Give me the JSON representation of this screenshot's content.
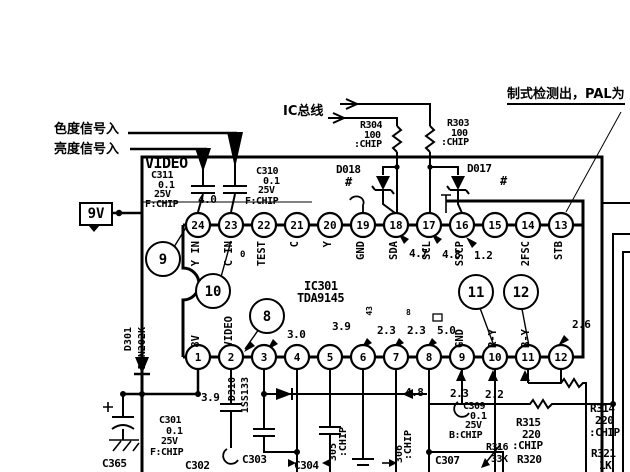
{
  "title": "TDA9145 chroma decoder schematic (scan)",
  "labels": {
    "v9": "9V"
  },
  "ic": {
    "ref": "IC301",
    "part": "TDA9145",
    "top_pins": [
      {
        "n": "24",
        "label": "Y IN"
      },
      {
        "n": "23",
        "label": "C IN"
      },
      {
        "n": "22",
        "label": "TEST"
      },
      {
        "n": "21",
        "label": "C"
      },
      {
        "n": "20",
        "label": "Y"
      },
      {
        "n": "19",
        "label": "GND"
      },
      {
        "n": "18",
        "label": "SDA"
      },
      {
        "n": "17",
        "label": "SCL"
      },
      {
        "n": "16",
        "label": "SSCP"
      },
      {
        "n": "15",
        "label": ""
      },
      {
        "n": "14",
        "label": "2FSC"
      },
      {
        "n": "13",
        "label": "STB"
      }
    ],
    "bottom_pins": [
      {
        "n": "1",
        "label": "8V"
      },
      {
        "n": "2",
        "label": "VIDEO"
      },
      {
        "n": "3",
        "label": ""
      },
      {
        "n": "4",
        "label": ""
      },
      {
        "n": "5",
        "label": ""
      },
      {
        "n": "6",
        "label": ""
      },
      {
        "n": "7",
        "label": ""
      },
      {
        "n": "8",
        "label": ""
      },
      {
        "n": "9",
        "label": "GND"
      },
      {
        "n": "10",
        "label": "R-Y"
      },
      {
        "n": "11",
        "label": "B-Y"
      },
      {
        "n": "12",
        "label": ""
      }
    ]
  },
  "callouts": [
    {
      "n": "9",
      "x": 163,
      "y": 259
    },
    {
      "n": "10",
      "x": 213,
      "y": 291
    },
    {
      "n": "8",
      "x": 267,
      "y": 316
    },
    {
      "n": "11",
      "x": 476,
      "y": 292
    },
    {
      "n": "12",
      "x": 521,
      "y": 292
    }
  ],
  "texts": [
    {
      "name": "chroma-in-label",
      "t": "色度信号入",
      "x": 54,
      "y": 123,
      "s": 13,
      "zh": 1
    },
    {
      "name": "luma-in-label",
      "t": "亮度信号入",
      "x": 54,
      "y": 143,
      "s": 13,
      "zh": 1
    },
    {
      "name": "ic-bus-label",
      "t": "IC总线",
      "x": 283,
      "y": 105,
      "s": 13,
      "zh": 1
    },
    {
      "name": "standard-detect-label",
      "t": "制式检测出，PAL为",
      "x": 507,
      "y": 88,
      "s": 13,
      "zh": 1,
      "ul": 1
    },
    {
      "name": "video-block-label",
      "t": "VIDEO",
      "x": 145,
      "y": 156,
      "s": 15
    },
    {
      "name": "c311-ref",
      "t": "C311",
      "x": 151,
      "y": 171,
      "s": 10
    },
    {
      "name": "c311-value",
      "t": "0.1",
      "x": 158,
      "y": 181,
      "s": 10
    },
    {
      "name": "c311-voltage",
      "t": "25V",
      "x": 154,
      "y": 190,
      "s": 10
    },
    {
      "name": "c311-type",
      "t": "F:CHIP",
      "x": 145,
      "y": 200,
      "s": 10
    },
    {
      "name": "c310-ref",
      "t": "C310",
      "x": 256,
      "y": 167,
      "s": 10
    },
    {
      "name": "c310-value",
      "t": "0.1",
      "x": 263,
      "y": 177,
      "s": 10
    },
    {
      "name": "c310-voltage",
      "t": "25V",
      "x": 258,
      "y": 186,
      "s": 10
    },
    {
      "name": "c310-type",
      "t": "F:CHIP",
      "x": 245,
      "y": 197,
      "s": 10
    },
    {
      "name": "pin24-voltage",
      "t": "4.0",
      "x": 198,
      "y": 194,
      "s": 11
    },
    {
      "name": "r304-ref",
      "t": "R304",
      "x": 360,
      "y": 121,
      "s": 10
    },
    {
      "name": "r304-value",
      "t": "100",
      "x": 364,
      "y": 131,
      "s": 10
    },
    {
      "name": "r304-type",
      "t": ":CHIP",
      "x": 354,
      "y": 140,
      "s": 10
    },
    {
      "name": "r303-ref",
      "t": "R303",
      "x": 447,
      "y": 119,
      "s": 10
    },
    {
      "name": "r303-value",
      "t": "100",
      "x": 451,
      "y": 129,
      "s": 10
    },
    {
      "name": "r303-type",
      "t": ":CHIP",
      "x": 441,
      "y": 138,
      "s": 10
    },
    {
      "name": "d018-ref",
      "t": "D018",
      "x": 336,
      "y": 164,
      "s": 11
    },
    {
      "name": "d018-mark",
      "t": "#",
      "x": 345,
      "y": 176,
      "s": 12
    },
    {
      "name": "d017-ref",
      "t": "D017",
      "x": 467,
      "y": 163,
      "s": 11
    },
    {
      "name": "d017-mark",
      "t": "#",
      "x": 500,
      "y": 175,
      "s": 12
    },
    {
      "name": "ic-ref",
      "t": "IC301",
      "x": 304,
      "y": 280,
      "s": 12
    },
    {
      "name": "ic-part",
      "t": "TDA9145",
      "x": 297,
      "y": 292,
      "s": 12
    },
    {
      "name": "pin23-note",
      "t": "0",
      "x": 240,
      "y": 251,
      "s": 9
    },
    {
      "name": "pin18-voltage",
      "t": "4.7",
      "x": 409,
      "y": 248,
      "s": 11
    },
    {
      "name": "pin17-voltage",
      "t": "4.8",
      "x": 442,
      "y": 249,
      "s": 11
    },
    {
      "name": "pin16-voltage",
      "t": "1.2",
      "x": 474,
      "y": 250,
      "s": 11
    },
    {
      "name": "pin3-voltage",
      "t": "3.0",
      "x": 287,
      "y": 329,
      "s": 11
    },
    {
      "name": "pin5-voltage",
      "t": "3.9",
      "x": 332,
      "y": 321,
      "s": 11
    },
    {
      "name": "pin6-note",
      "t": "43",
      "x": 366,
      "y": 306,
      "s": 8,
      "v": 1
    },
    {
      "name": "pin6-voltage",
      "t": "2.3",
      "x": 377,
      "y": 325,
      "s": 11
    },
    {
      "name": "pin7-note",
      "t": "8",
      "x": 406,
      "y": 309,
      "s": 8
    },
    {
      "name": "pin7-voltage",
      "t": "2.3",
      "x": 407,
      "y": 325,
      "s": 11
    },
    {
      "name": "pin8-voltage",
      "t": "5.0",
      "x": 437,
      "y": 325,
      "s": 11
    },
    {
      "name": "pin12-voltage",
      "t": "2.6",
      "x": 572,
      "y": 319,
      "s": 11
    },
    {
      "name": "pin2-voltage",
      "t": "3.9",
      "x": 201,
      "y": 392,
      "s": 11
    },
    {
      "name": "pin8-lower-voltage",
      "t": "4.8",
      "x": 405,
      "y": 387,
      "s": 11
    },
    {
      "name": "pin10-voltage",
      "t": "2.3",
      "x": 450,
      "y": 388,
      "s": 11
    },
    {
      "name": "pin11-voltage",
      "t": "2.2",
      "x": 485,
      "y": 389,
      "s": 11
    },
    {
      "name": "d301-ref",
      "t": "D301",
      "x": 124,
      "y": 327,
      "s": 10,
      "v": 1
    },
    {
      "name": "d301-part",
      "t": "DAN202K",
      "x": 138,
      "y": 327,
      "s": 10,
      "v": 1
    },
    {
      "name": "d310-ref",
      "t": "D310",
      "x": 228,
      "y": 377,
      "s": 10,
      "v": 1
    },
    {
      "name": "d310-part",
      "t": "1SS133",
      "x": 241,
      "y": 377,
      "s": 10,
      "v": 1
    },
    {
      "name": "c301-ref",
      "t": "C301",
      "x": 159,
      "y": 416,
      "s": 10
    },
    {
      "name": "c301-value",
      "t": "0.1",
      "x": 166,
      "y": 427,
      "s": 10
    },
    {
      "name": "c301-voltage",
      "t": "25V",
      "x": 161,
      "y": 437,
      "s": 10
    },
    {
      "name": "c301-type",
      "t": "F:CHIP",
      "x": 150,
      "y": 448,
      "s": 10
    },
    {
      "name": "c365-ref",
      "t": "C365",
      "x": 102,
      "y": 458,
      "s": 11
    },
    {
      "name": "c302-ref",
      "t": "C302",
      "x": 185,
      "y": 460,
      "s": 11
    },
    {
      "name": "c303-ref",
      "t": "C303",
      "x": 242,
      "y": 454,
      "s": 11
    },
    {
      "name": "c304-ref",
      "t": "C304",
      "x": 294,
      "y": 460,
      "s": 11
    },
    {
      "name": "c305-ref",
      "t": "305",
      "x": 329,
      "y": 443,
      "s": 10,
      "v": 1
    },
    {
      "name": "c305-type",
      "t": ":CHIP",
      "x": 339,
      "y": 427,
      "s": 10,
      "v": 1
    },
    {
      "name": "c306-ref",
      "t": "306",
      "x": 395,
      "y": 445,
      "s": 10,
      "v": 1
    },
    {
      "name": "c306-type",
      "t": ":CHIP",
      "x": 404,
      "y": 430,
      "s": 10,
      "v": 1
    },
    {
      "name": "c309-ref",
      "t": "C309",
      "x": 463,
      "y": 402,
      "s": 10
    },
    {
      "name": "c309-value",
      "t": "0.1",
      "x": 470,
      "y": 412,
      "s": 10
    },
    {
      "name": "c309-voltage",
      "t": "25V",
      "x": 465,
      "y": 421,
      "s": 10
    },
    {
      "name": "c309-type",
      "t": "B:CHIP",
      "x": 449,
      "y": 431,
      "s": 10
    },
    {
      "name": "r315-ref",
      "t": "R315",
      "x": 516,
      "y": 417,
      "s": 11
    },
    {
      "name": "r315-value",
      "t": "220",
      "x": 522,
      "y": 429,
      "s": 11
    },
    {
      "name": "r315-type",
      "t": ":CHIP",
      "x": 512,
      "y": 440,
      "s": 11
    },
    {
      "name": "r314-ref",
      "t": "R314",
      "x": 590,
      "y": 403,
      "s": 11
    },
    {
      "name": "r314-value",
      "t": "220",
      "x": 595,
      "y": 415,
      "s": 11
    },
    {
      "name": "r314-type",
      "t": ":CHIP",
      "x": 589,
      "y": 427,
      "s": 11
    },
    {
      "name": "r321-ref",
      "t": "R321",
      "x": 591,
      "y": 448,
      "s": 11
    },
    {
      "name": "r321-value",
      "t": "1K",
      "x": 599,
      "y": 460,
      "s": 11
    },
    {
      "name": "r316-ref",
      "t": "R316",
      "x": 486,
      "y": 443,
      "s": 10
    },
    {
      "name": "r316-value",
      "t": "33K",
      "x": 491,
      "y": 455,
      "s": 10
    },
    {
      "name": "r320-ref",
      "t": "R320",
      "x": 517,
      "y": 454,
      "s": 11
    },
    {
      "name": "c307-ref",
      "t": "C307",
      "x": 435,
      "y": 455,
      "s": 11
    }
  ]
}
